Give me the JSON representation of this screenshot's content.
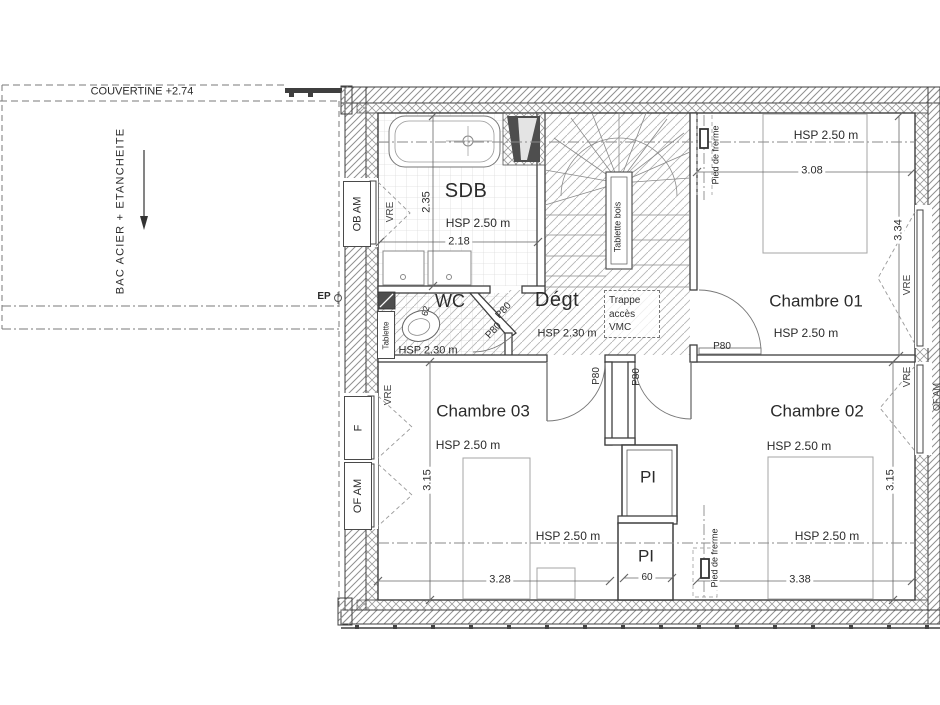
{
  "title": "Plan d'étage - combles",
  "rooms": {
    "sdb": "SDB",
    "wc": "WC",
    "degt": "Dégt",
    "ch01": "Chambre 01",
    "ch02": "Chambre 02",
    "ch03": "Chambre 03",
    "pi": "PI"
  },
  "heights": {
    "hsp250": "HSP 2.50 m",
    "hsp230": "HSP 2.30 m"
  },
  "dims": {
    "sdb_w": "2.18",
    "sdb_d": "2.35",
    "ch01_w": "3.08",
    "ch01_d": "3.34",
    "ch02_w": "3.38",
    "ch02_d": "3.15",
    "ch03_w": "3.28",
    "ch03_d": "3.15",
    "pi_w": "60",
    "wc_d": "62"
  },
  "annotations": {
    "couvertine": "COUVERTINE +2.74",
    "bac_acier": "BAC ACIER + ETANCHEITE",
    "ep": "EP",
    "trappe1": "Trappe",
    "trappe2": "accès",
    "trappe3": "VMC",
    "tablette": "Tablette",
    "tablette_bois": "Tablette bois",
    "pied_de_ferme": "Pied de frerme"
  },
  "joinery": {
    "ob_am": "OB AM",
    "of_am": "OF AM",
    "f": "F",
    "vre": "VRE",
    "p80": "P80"
  },
  "colors": {
    "line": "#3f3f3f",
    "wall_hatch": "#8f8f8f",
    "floor_hatch": "#b5b5b5",
    "tile": "#dcdcdc",
    "dark_fill": "#4e4e4e",
    "background": "#ffffff"
  }
}
